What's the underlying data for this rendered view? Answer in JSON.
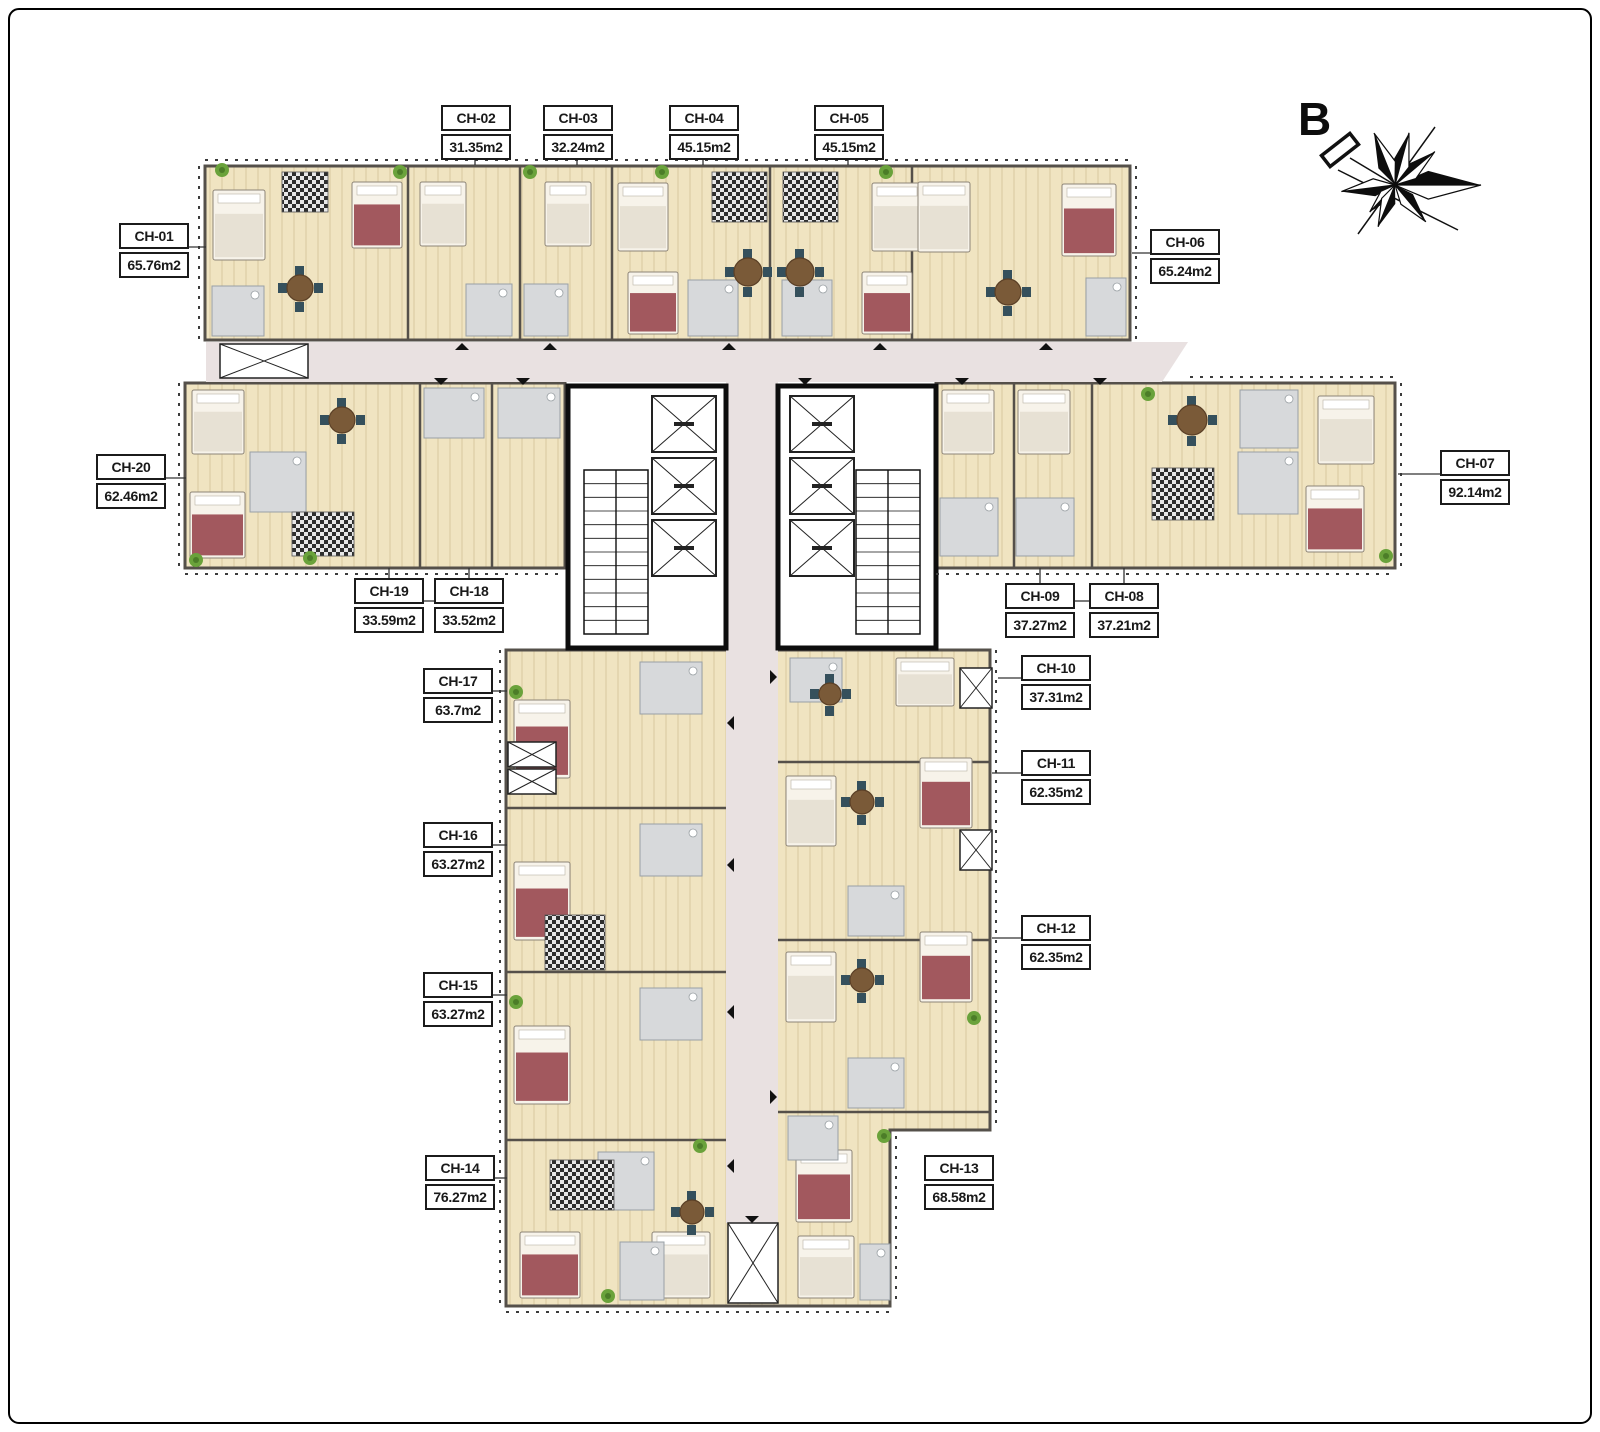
{
  "compass": {
    "label": "B"
  },
  "units": [
    {
      "id": "CH-01",
      "area": "65.76m2"
    },
    {
      "id": "CH-02",
      "area": "31.35m2"
    },
    {
      "id": "CH-03",
      "area": "32.24m2"
    },
    {
      "id": "CH-04",
      "area": "45.15m2"
    },
    {
      "id": "CH-05",
      "area": "45.15m2"
    },
    {
      "id": "CH-06",
      "area": "65.24m2"
    },
    {
      "id": "CH-07",
      "area": "92.14m2"
    },
    {
      "id": "CH-08",
      "area": "37.21m2"
    },
    {
      "id": "CH-09",
      "area": "37.27m2"
    },
    {
      "id": "CH-10",
      "area": "37.31m2"
    },
    {
      "id": "CH-11",
      "area": "62.35m2"
    },
    {
      "id": "CH-12",
      "area": "62.35m2"
    },
    {
      "id": "CH-13",
      "area": "68.58m2"
    },
    {
      "id": "CH-14",
      "area": "76.27m2"
    },
    {
      "id": "CH-15",
      "area": "63.27m2"
    },
    {
      "id": "CH-16",
      "area": "63.27m2"
    },
    {
      "id": "CH-17",
      "area": "63.7m2"
    },
    {
      "id": "CH-18",
      "area": "33.52m2"
    },
    {
      "id": "CH-19",
      "area": "33.59m2"
    },
    {
      "id": "CH-20",
      "area": "62.46m2"
    }
  ],
  "palette": {
    "paper": "#ffffff",
    "frame": "#000000",
    "floor": "#f0e4c1",
    "wall": "#55504a",
    "corridor": "#e9e1e1",
    "bath": "#d7d9db",
    "coreWall": "#0d0d0d",
    "labelBorder": "#1b1b1b",
    "bedBlanketRed": "#a2585e",
    "bedBlanketWhite": "#e7e1d4",
    "chairTeal": "#35505c",
    "tableBrown": "#7a5a38",
    "plantGreen": "#6aa23b"
  }
}
